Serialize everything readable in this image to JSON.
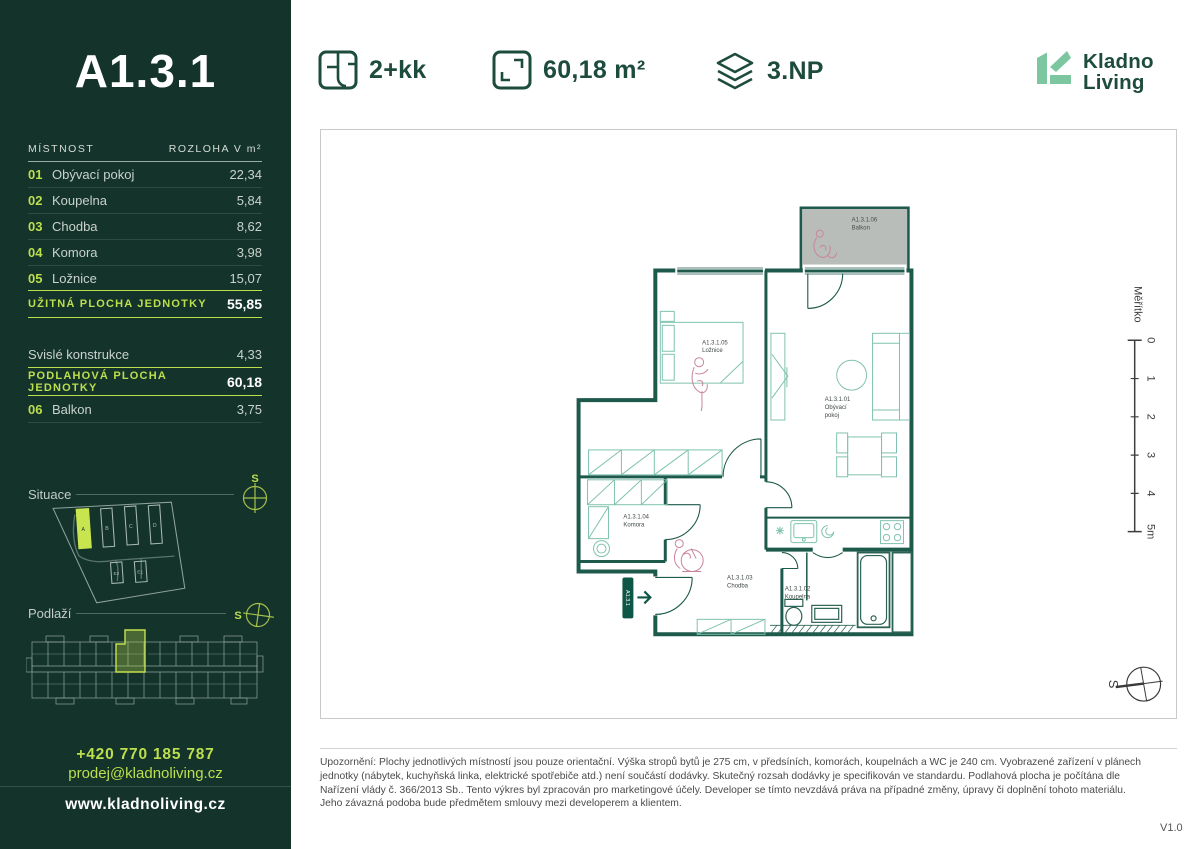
{
  "header": {
    "layout": "2+kk",
    "area": "60,18 m²",
    "floor": "3.NP",
    "brand": {
      "line1": "Kladno",
      "line2": "Living"
    }
  },
  "sidebar": {
    "unit_title": "A1.3.1",
    "table": {
      "col_room": "MÍSTNOST",
      "col_area": "ROZLOHA V m²",
      "rows": [
        {
          "num": "01",
          "name": "Obývací pokoj",
          "area": "22,34"
        },
        {
          "num": "02",
          "name": "Koupelna",
          "area": "5,84"
        },
        {
          "num": "03",
          "name": "Chodba",
          "area": "8,62"
        },
        {
          "num": "04",
          "name": "Komora",
          "area": "3,98"
        },
        {
          "num": "05",
          "name": "Ložnice",
          "area": "15,07"
        }
      ],
      "usable": {
        "label": "UŽITNÁ PLOCHA JEDNOTKY",
        "value": "55,85"
      },
      "vertical": {
        "label": "Svislé konstrukce",
        "value": "4,33"
      },
      "floor_total": {
        "label": "PODLAHOVÁ PLOCHA JEDNOTKY",
        "value": "60,18"
      },
      "balcony": {
        "num": "06",
        "name": "Balkon",
        "value": "3,75"
      }
    },
    "situace": {
      "label": "Situace",
      "compass": "S"
    },
    "site_buildings": [
      "A",
      "B",
      "C",
      "D",
      "E2",
      "E1"
    ],
    "podlazi": {
      "label": "Podlaží",
      "compass": "S"
    },
    "contact": {
      "phone": "+420 770 185 787",
      "email": "prodej@kladnoliving.cz",
      "web": "www.kladnoliving.cz"
    }
  },
  "plan": {
    "entry_tag": "A1.3.1",
    "compass": "S",
    "scale": {
      "label": "Měřítko",
      "ticks": [
        "0",
        "1",
        "2",
        "3",
        "4",
        "5m"
      ]
    },
    "labels": {
      "living": {
        "code": "A1.3.1.01",
        "name1": "Obývací",
        "name2": "pokoj"
      },
      "koupelna": {
        "code": "A1.3.1.02",
        "name": "Koupelna"
      },
      "chodba": {
        "code": "A1.3.1.03",
        "name": "Chodba"
      },
      "komora": {
        "code": "A1.3.1.04",
        "name": "Komora"
      },
      "loznice": {
        "code": "A1.3.1.05",
        "name": "Ložnice"
      },
      "balkon": {
        "code": "A1.3.1.06",
        "name": "Balkon"
      }
    }
  },
  "footer": {
    "disclaimer_lines": [
      "Upozornění: Plochy jednotlivých místností jsou pouze orientační. Výška stropů bytů je 275 cm, v předsíních, komorách, koupelnách a WC je 240 cm. Vyobrazené zařízení v plánech",
      "jednotky (nábytek, kuchyňská linka, elektrické spotřebiče atd.) není součástí dodávky. Skutečný rozsah dodávky je specifikován ve standardu. Podlahová plocha je počítána dle",
      "Nařízení vlády č. 366/2013 Sb.. Tento výkres byl zpracován pro marketingové účely. Developer se tímto nevzdává práva na případné změny, úpravy či doplnění tohoto materiálu.",
      "Jeho závazná podoba bude předmětem smlouvy mezi developerem a klientem."
    ],
    "version": "V1.0"
  },
  "colors": {
    "sidebar_bg": "#14332b",
    "accent_lime": "#bcdf4e",
    "header_green": "#1d4b3d",
    "logo_mint": "#7cc7a0",
    "wall_teal": "#1d5a4b",
    "furniture_teal": "#7fc2ae",
    "figure_pink": "#c9849a",
    "balcony_gray": "#b9bdb9"
  }
}
